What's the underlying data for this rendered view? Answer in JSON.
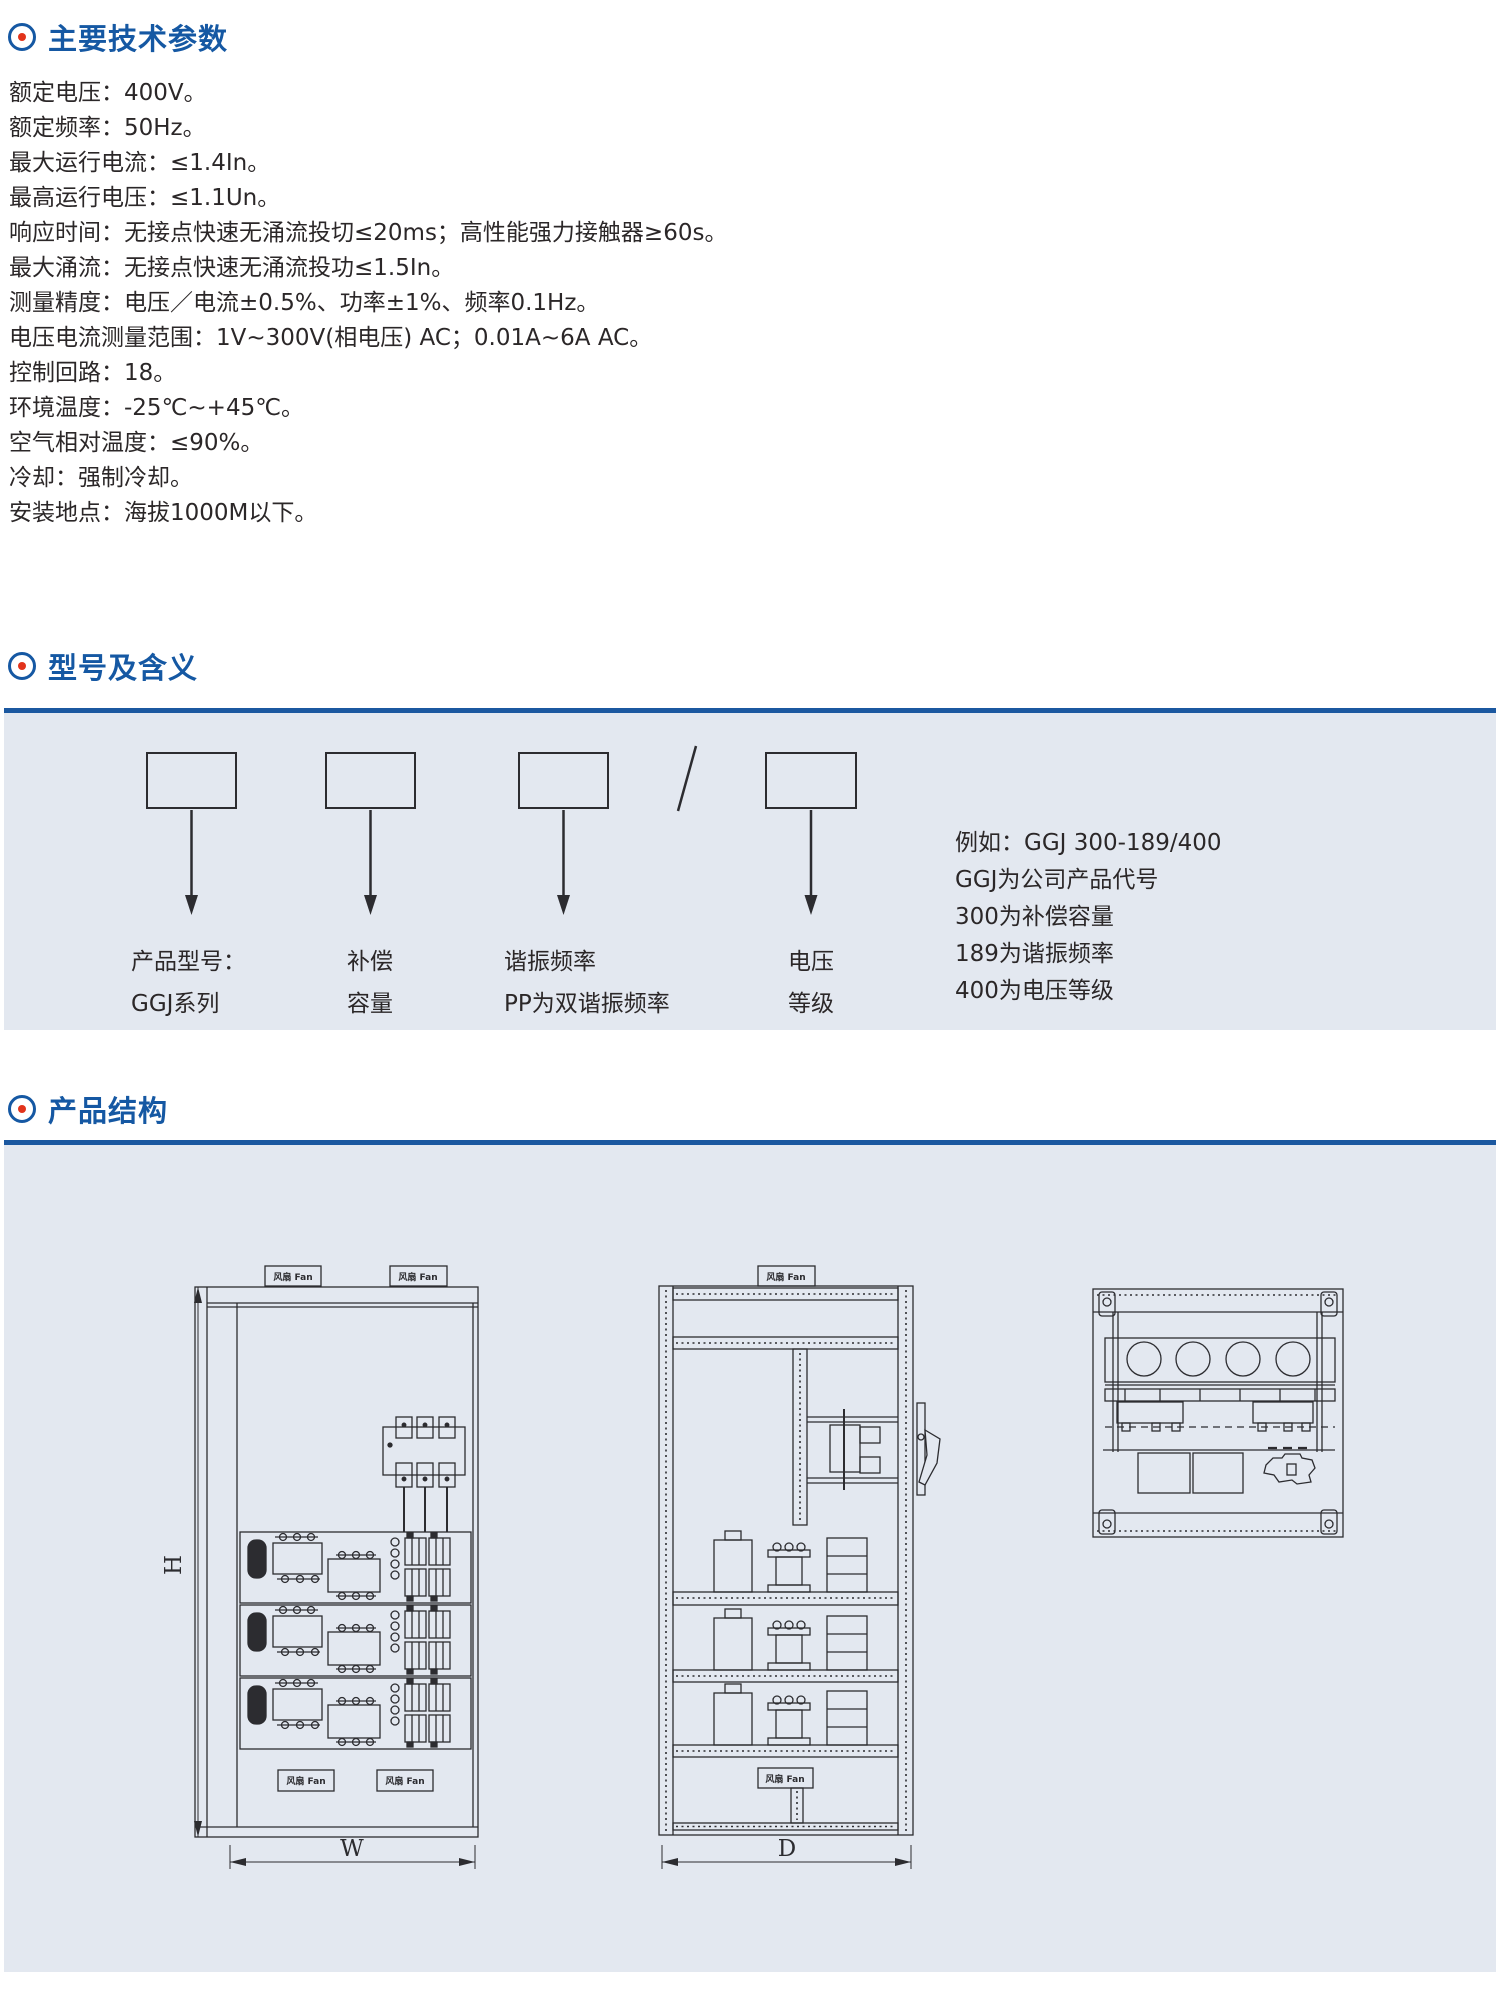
{
  "meta": {
    "accent_blue": "#1558a3",
    "accent_red": "#e2331b",
    "rule_blue": "#1b58a0",
    "panel_bg": "#e3e8f0",
    "ink": "#2c2c30"
  },
  "section1": {
    "title": "主要技术参数",
    "items": [
      "额定电压：400V。",
      "额定频率：50Hz。",
      "最大运行电流：≤1.4In。",
      "最高运行电压：≤1.1Un。",
      "响应时间：无接点快速无涌流投切≤20ms；高性能强力接触器≥60s。",
      "最大涌流：无接点快速无涌流投功≤1.5In。",
      "测量精度：电压／电流±0.5%、功率±1%、频率0.1Hz。",
      "电压电流测量范围：1V~300V(相电压) AC；0.01A~6A AC。",
      "控制回路：18。",
      "环境温度：-25℃~+45℃。",
      "空气相对温度：≤90%。",
      "冷却：强制冷却。",
      "安装地点：海拔1000M以下。"
    ]
  },
  "section2": {
    "title": "型号及含义",
    "slash": "/",
    "columns": [
      {
        "line1": "产品型号：",
        "line2": "GGJ系列"
      },
      {
        "line1": "补偿",
        "line2": "容量"
      },
      {
        "line1": "谐振频率",
        "line2": "PP为双谐振频率"
      },
      {
        "line1": "电压",
        "line2": "等级"
      }
    ],
    "example": [
      "例如：GGJ 300-189/400",
      "GGJ为公司产品代号",
      "300为补偿容量",
      "189为谐振频率",
      "400为电压等级"
    ]
  },
  "section3": {
    "title": "产品结构",
    "fan_label": "风扇 Fan",
    "dim_height": "H",
    "dim_width": "W",
    "dim_depth": "D"
  }
}
